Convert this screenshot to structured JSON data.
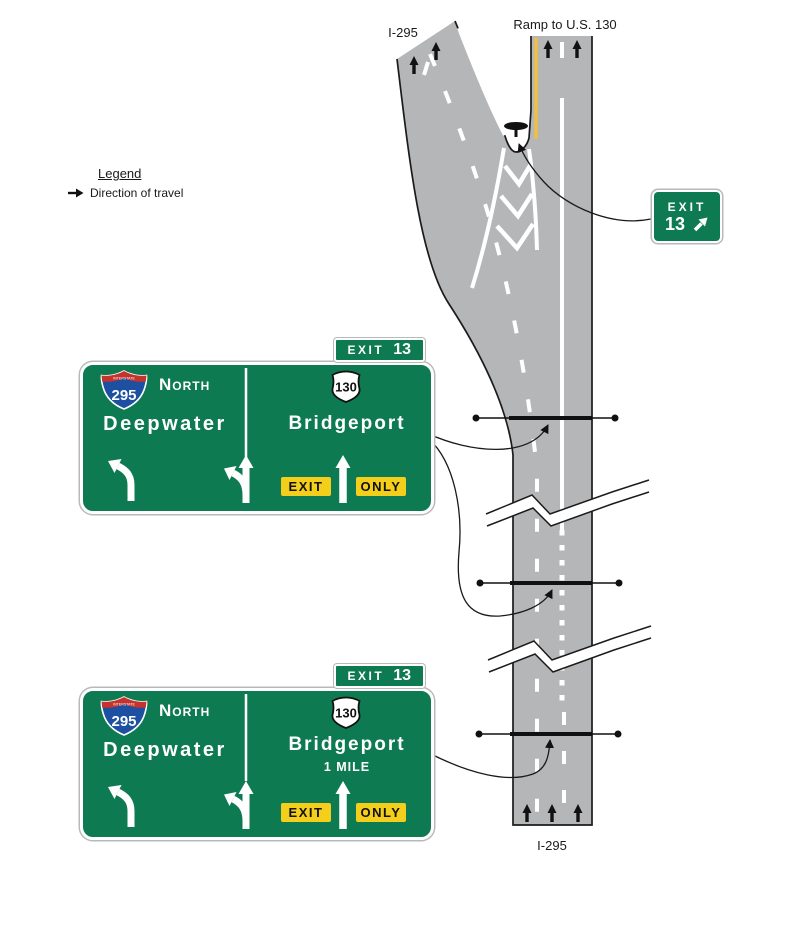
{
  "colors": {
    "sign_green": "#0e7a51",
    "plaque_yellow": "#f3cf1c",
    "road_gray": "#b5b6b8",
    "edge_yellow": "#f0bf45",
    "shield_blue": "#1d50a0",
    "shield_red": "#c6322c"
  },
  "legend": {
    "title": "Legend",
    "item": "Direction of travel"
  },
  "road": {
    "top_left_label": "I-295",
    "top_right_label": "Ramp to U.S. 130",
    "bottom_label": "I-295"
  },
  "ramp_sign": {
    "exit_word": "EXIT",
    "exit_number": "13"
  },
  "signs": [
    {
      "tab_exit": "EXIT",
      "tab_number": "13",
      "interstate_label": "INTERSTATE",
      "interstate_number": "295",
      "direction": "North",
      "left_destination": "Deepwater",
      "route_number": "130",
      "right_destination": "Bridgeport",
      "distance": "",
      "exit_plaque": "EXIT",
      "only_plaque": "ONLY"
    },
    {
      "tab_exit": "EXIT",
      "tab_number": "13",
      "interstate_label": "INTERSTATE",
      "interstate_number": "295",
      "direction": "North",
      "left_destination": "Deepwater",
      "route_number": "130",
      "right_destination": "Bridgeport",
      "distance": "1 MILE",
      "exit_plaque": "EXIT",
      "only_plaque": "ONLY"
    }
  ]
}
